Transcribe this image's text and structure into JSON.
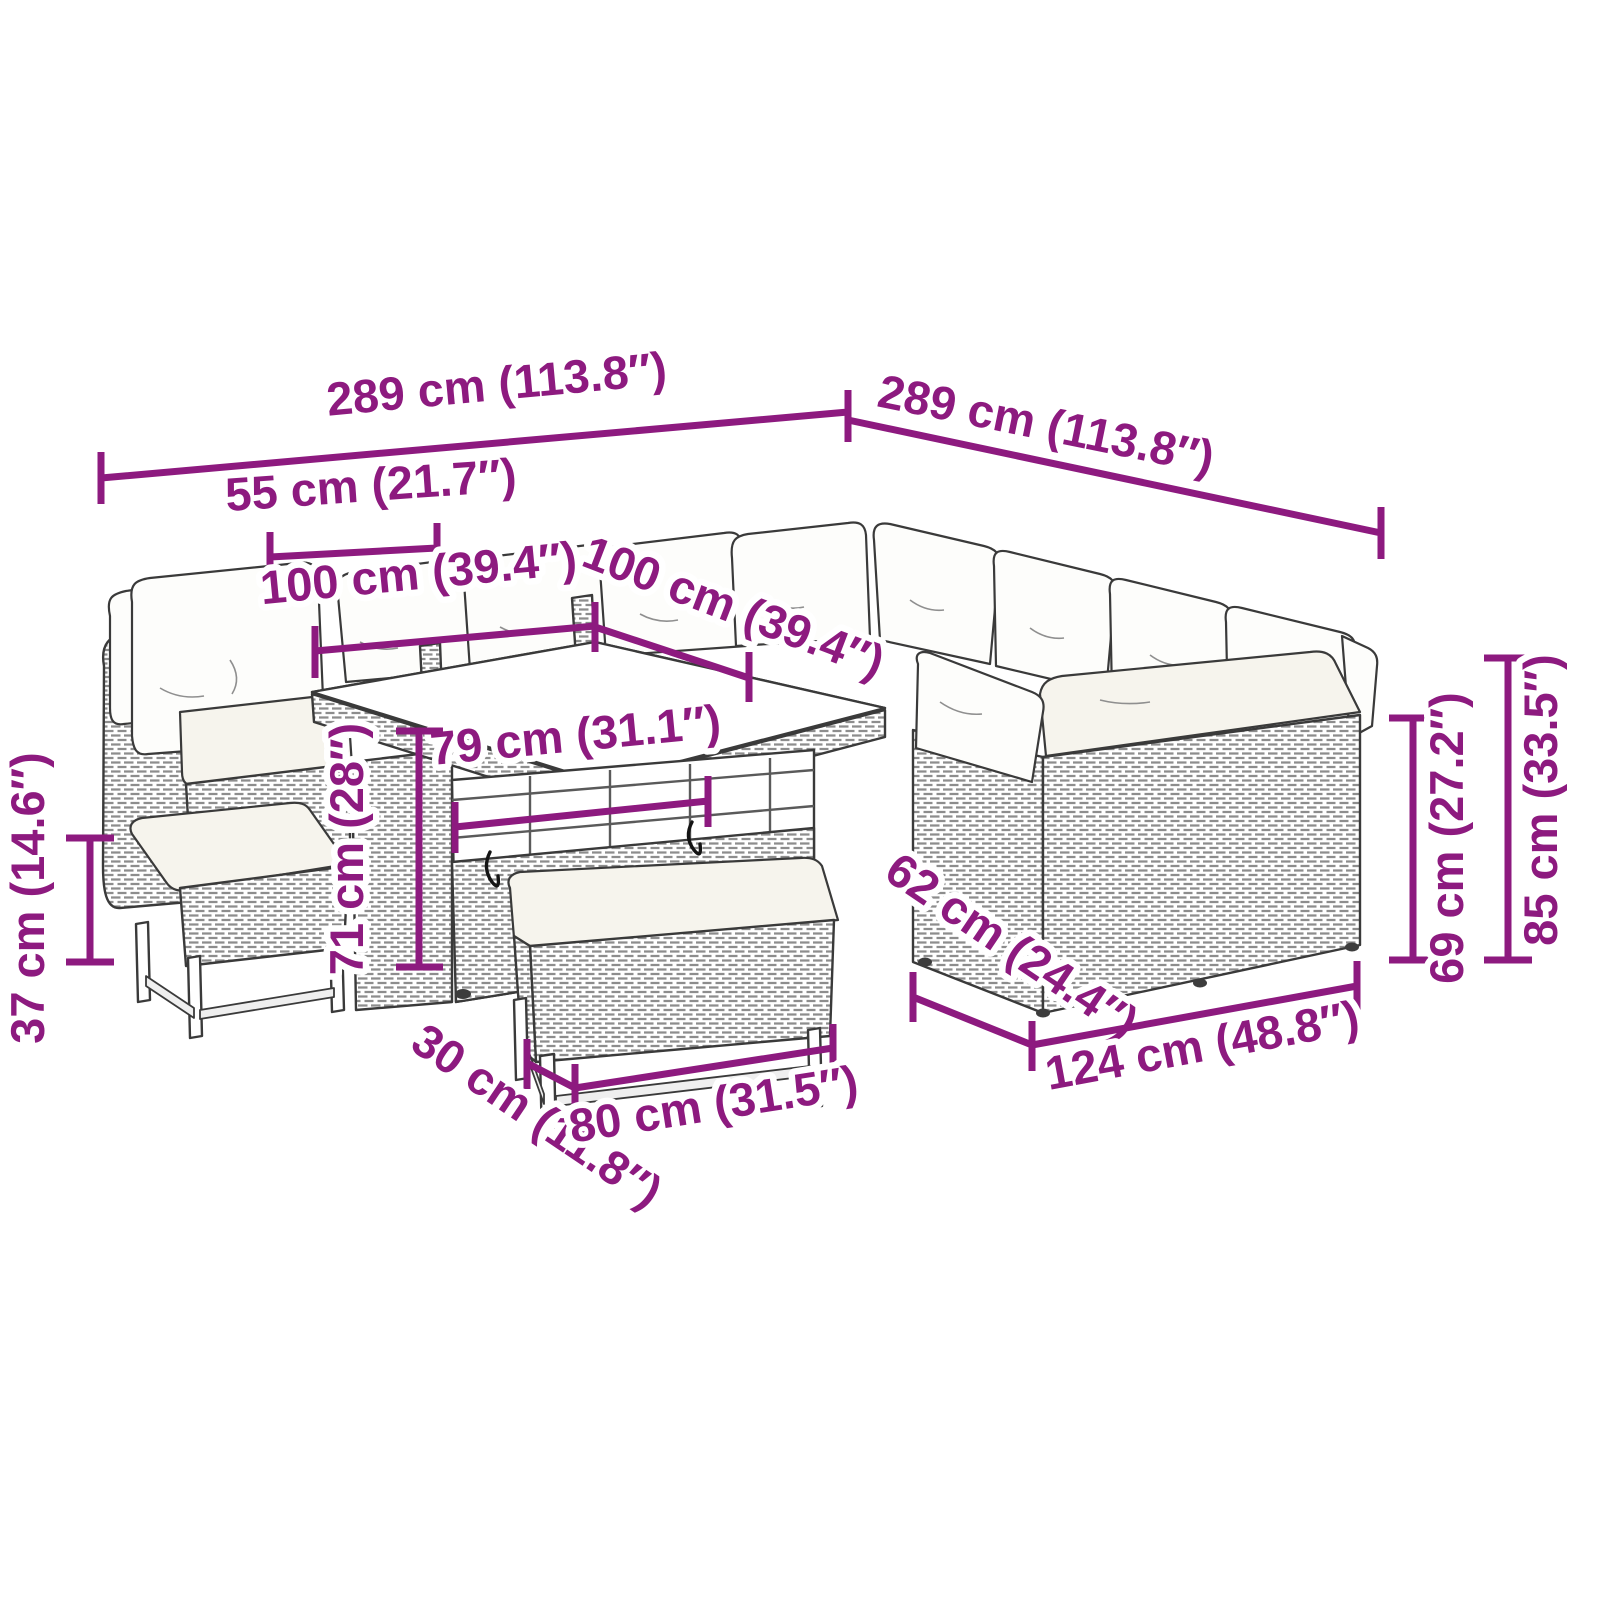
{
  "figure": {
    "kind": "product-dimension-diagram"
  },
  "colors": {
    "dimension_accent": "#8D1A7F",
    "line_art": "#3A3A3A",
    "rattan_weave": "#8D8D8D",
    "cushion_fill": "#F6F4ED",
    "background": "#FFFFFF"
  },
  "dims": {
    "back_width_left": {
      "label": "289 cm (113.8″)"
    },
    "back_width_right": {
      "label": "289 cm (113.8″)"
    },
    "corner_section_width": {
      "label": "55 cm (21.7″)"
    },
    "table_width": {
      "label": "100 cm (39.4″)"
    },
    "table_depth": {
      "label": "100 cm (39.4″)"
    },
    "table_inner_width": {
      "label": "79 cm (31.1″)"
    },
    "table_height": {
      "label": "71 cm (28″)"
    },
    "bench_height": {
      "label": "37 cm (14.6″)"
    },
    "bench_depth": {
      "label": "30 cm (11.8″)"
    },
    "bench_width": {
      "label": "80 cm (31.5″)"
    },
    "module_depth": {
      "label": "62 cm (24.4″)"
    },
    "module_width": {
      "label": "124 cm (48.8″)"
    },
    "seat_height": {
      "label": "69 cm (27.2″)"
    },
    "total_height": {
      "label": "85 cm (33.5″)"
    }
  }
}
